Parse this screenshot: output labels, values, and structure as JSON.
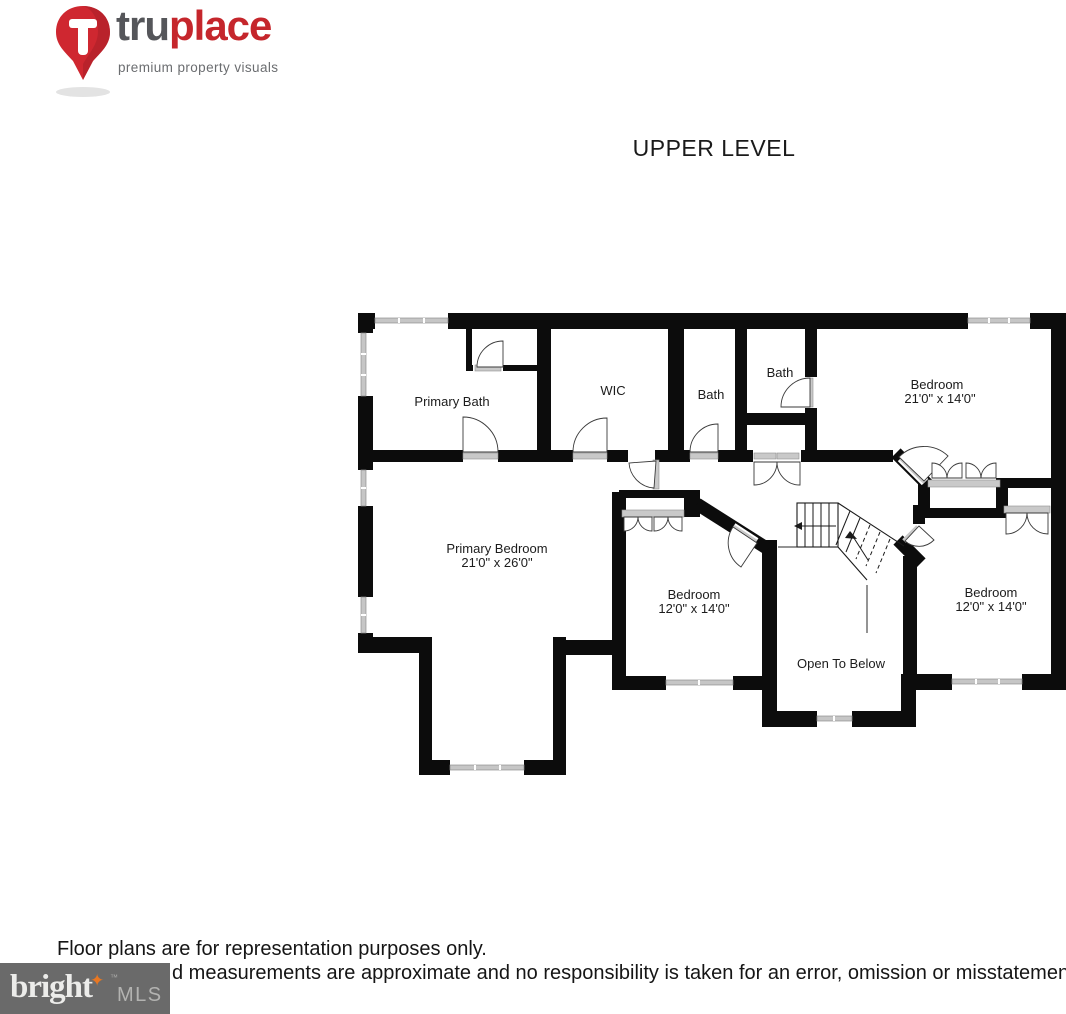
{
  "header": {
    "logo": {
      "brand_tru": "tru",
      "brand_place": "place",
      "tagline": "premium property visuals"
    }
  },
  "title": "UPPER LEVEL",
  "floor_plan": {
    "rooms": [
      {
        "name": "Primary Bath",
        "dims": ""
      },
      {
        "name": "WIC",
        "dims": ""
      },
      {
        "name": "Bath",
        "dims": ""
      },
      {
        "name": "Bath",
        "dims": ""
      },
      {
        "name": "Bedroom",
        "dims": "21'0\" x 14'0\""
      },
      {
        "name": "Primary Bedroom",
        "dims": "21'0\" x 26'0\""
      },
      {
        "name": "Bedroom",
        "dims": "12'0\" x 14'0\""
      },
      {
        "name": "Open To Below",
        "dims": ""
      },
      {
        "name": "Bedroom",
        "dims": "12'0\" x 14'0\""
      }
    ]
  },
  "footer": {
    "disclaimer_line1": "Floor plans are for representation purposes only.",
    "disclaimer_line2": "d measurements are approximate and no responsibility is taken for an error, omission or misstatement.",
    "mls_logo": {
      "bright": "bright",
      "star": "✦",
      "tm": "™",
      "mls": "MLS"
    }
  },
  "colors": {
    "brand_red": "#c5262c",
    "brand_gray": "#55565a",
    "wall_black": "#0c0c0c",
    "window_gray": "#c6c6c6",
    "door_gray": "#c9c9c9",
    "mls_box_gray": "#6a6a6a",
    "mls_star_orange": "#e87722"
  }
}
